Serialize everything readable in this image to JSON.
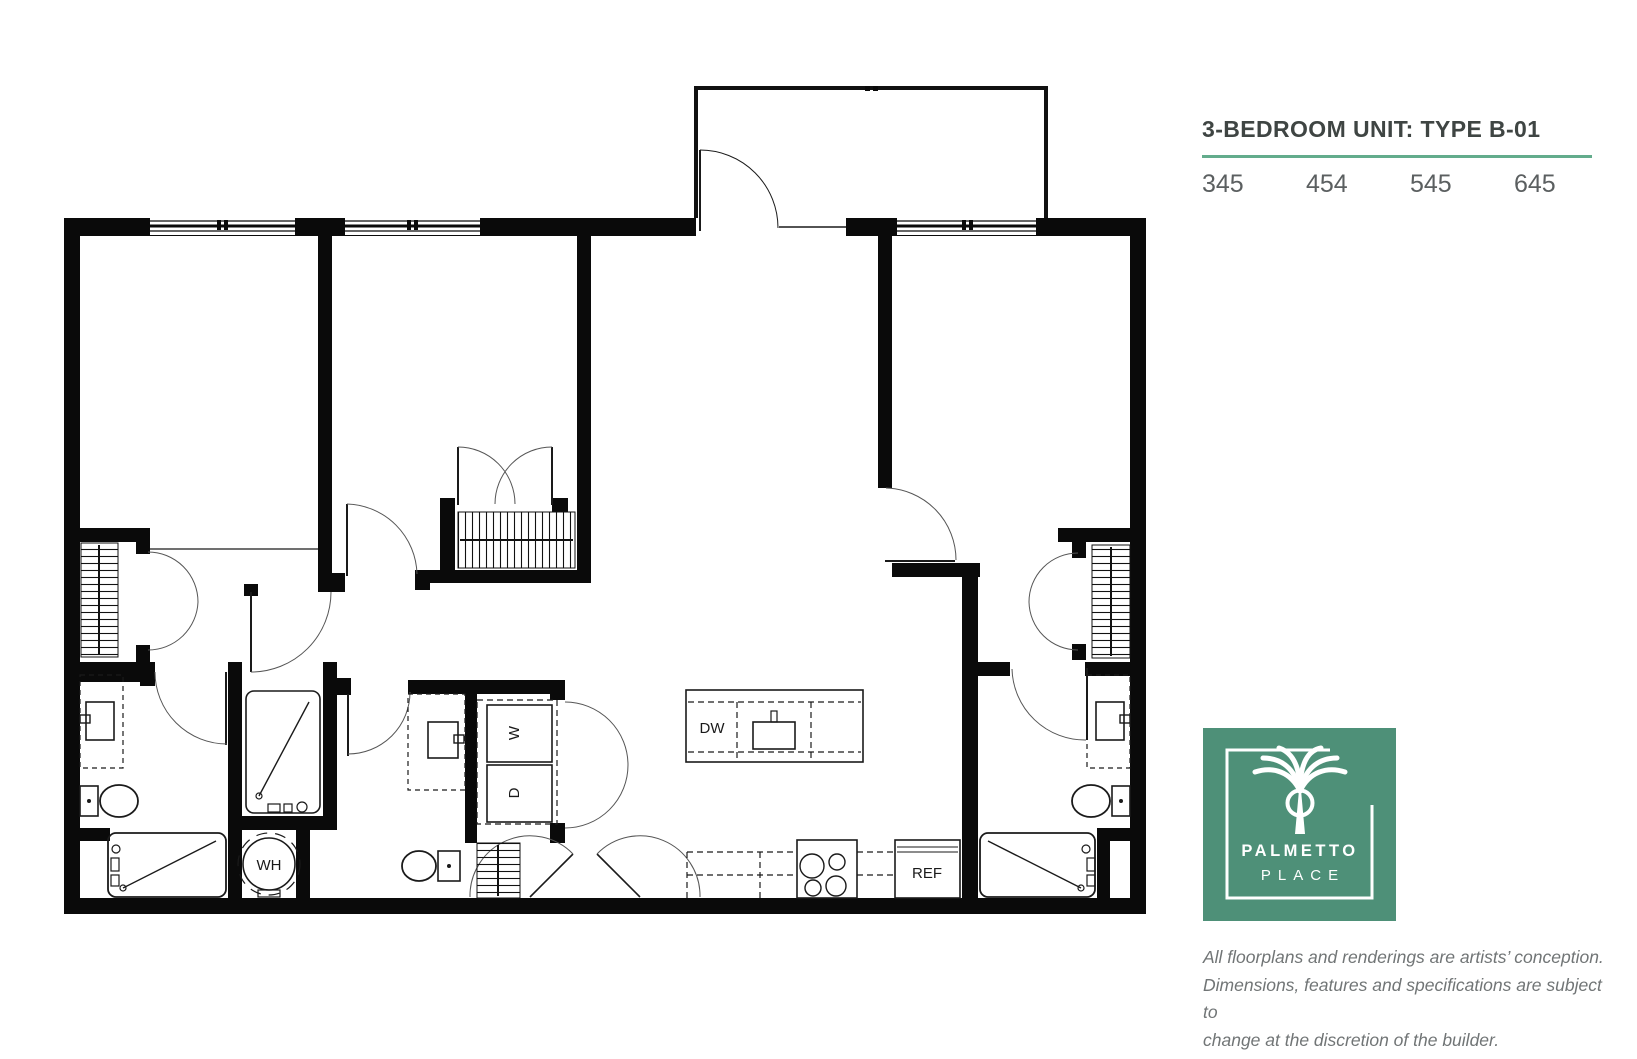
{
  "header": {
    "title": "3-BEDROOM UNIT: TYPE B-01",
    "units": [
      "345",
      "454",
      "545",
      "645"
    ]
  },
  "plan": {
    "labels": {
      "dishwasher": "DW",
      "washer": "W",
      "dryer": "D",
      "water_heater": "WH",
      "refrigerator": "REF"
    }
  },
  "logo": {
    "line1": "PALMETTO",
    "line2": "PLACE",
    "icon": "palm-tree-icon"
  },
  "disclaimer": {
    "line1": "All floorplans and renderings are artists’ conception.",
    "line2": "Dimensions, features and specifications are subject to",
    "line3": "change at the discretion of the builder."
  },
  "colors": {
    "brand_green": "#4E9078",
    "underline_green": "#63AC8C",
    "title_gray": "#3F4543",
    "number_gray": "#5B5F60",
    "disclaimer_gray": "#717576",
    "wall_black": "#0A0A0A"
  }
}
